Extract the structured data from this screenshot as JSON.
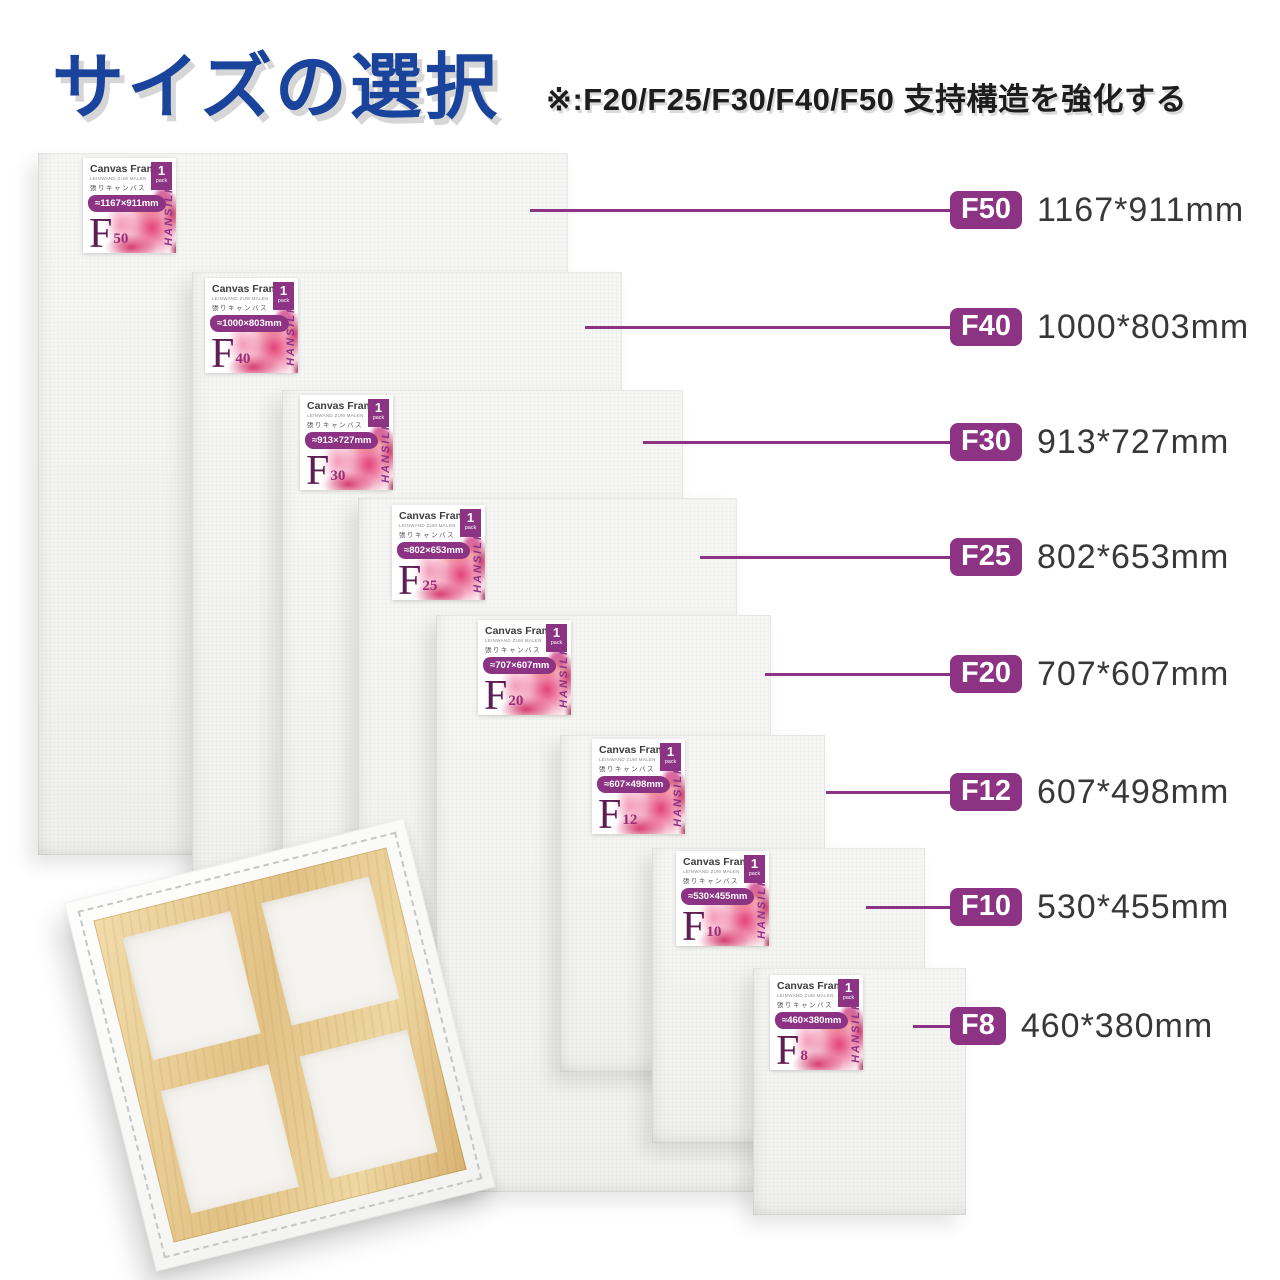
{
  "header": {
    "title": "サイズの選択",
    "note": "※:F20/F25/F30/F40/F50 支持構造を強化する"
  },
  "sticker": {
    "title": "Canvas Frame",
    "subtitle": "LEINWAND ZUM MALEN",
    "subtitle_jp": "張りキャンバス",
    "pack_count": "1",
    "pack_unit": "pack",
    "brand": "HANSILK"
  },
  "sizes": [
    {
      "code": "F50",
      "code_letter": "F",
      "code_number": "50",
      "label_dims": "1167*911mm",
      "sticker_dims": "≈1167×911mm"
    },
    {
      "code": "F40",
      "code_letter": "F",
      "code_number": "40",
      "label_dims": "1000*803mm",
      "sticker_dims": "≈1000×803mm"
    },
    {
      "code": "F30",
      "code_letter": "F",
      "code_number": "30",
      "label_dims": "913*727mm",
      "sticker_dims": "≈913×727mm"
    },
    {
      "code": "F25",
      "code_letter": "F",
      "code_number": "25",
      "label_dims": "802*653mm",
      "sticker_dims": "≈802×653mm"
    },
    {
      "code": "F20",
      "code_letter": "F",
      "code_number": "20",
      "label_dims": "707*607mm",
      "sticker_dims": "≈707×607mm"
    },
    {
      "code": "F12",
      "code_letter": "F",
      "code_number": "12",
      "label_dims": "607*498mm",
      "sticker_dims": "≈607×498mm"
    },
    {
      "code": "F10",
      "code_letter": "F",
      "code_number": "10",
      "label_dims": "530*455mm",
      "sticker_dims": "≈530×455mm"
    },
    {
      "code": "F8",
      "code_letter": "F",
      "code_number": "8",
      "label_dims": "460*380mm",
      "sticker_dims": "≈460×380mm"
    }
  ],
  "colors": {
    "accent_purple": "#8c3384",
    "title_blue": "#1a439b",
    "dims_text": "#383838",
    "canvas_face": "#f4f4f2",
    "wood": "#e8c98c"
  }
}
